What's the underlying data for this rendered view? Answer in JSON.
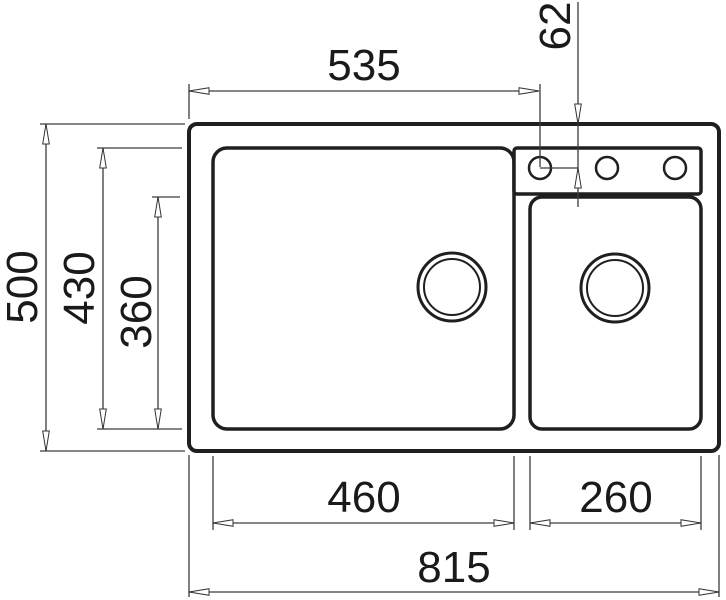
{
  "drawing": {
    "dimensions": {
      "tap_center_from_left": "535",
      "tap_center_from_top": "62",
      "overall_depth": "500",
      "left_bowl_depth": "430",
      "right_bowl_depth": "360",
      "left_bowl_width": "460",
      "right_bowl_width": "260",
      "overall_width": "815"
    }
  }
}
